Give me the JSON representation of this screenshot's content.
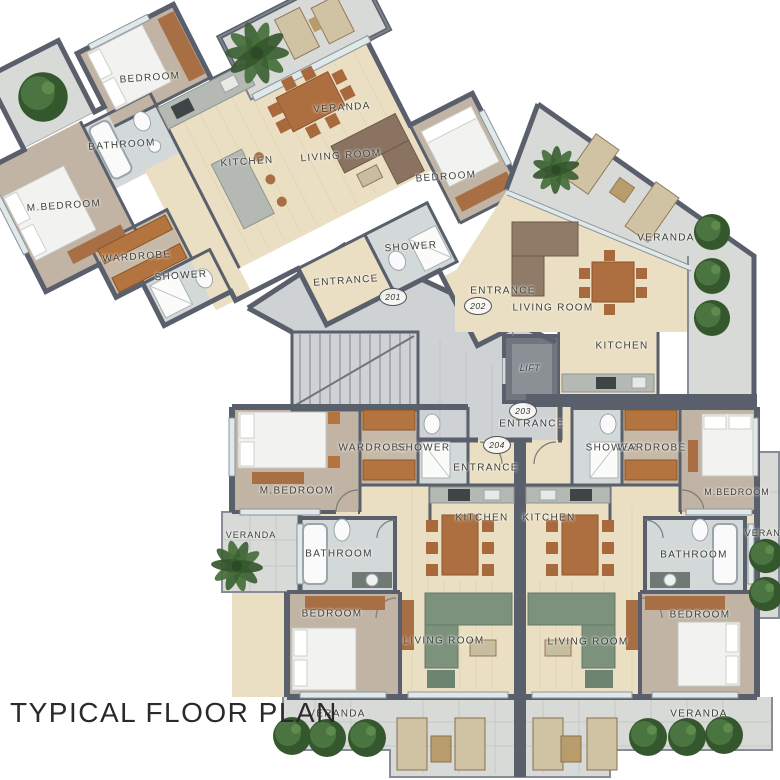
{
  "title": "TYPICAL FLOOR PLAN",
  "core": {
    "lift": "LIFT"
  },
  "units": [
    {
      "number": "201",
      "rooms": {
        "bedroom": "BEDROOM",
        "bathroom": "BATHROOM",
        "master_bedroom": "M.BEDROOM",
        "wardrobe": "WARDROBE",
        "shower": "SHOWER",
        "kitchen": "KITCHEN",
        "living_room": "LIVING ROOM",
        "veranda": "VERANDA",
        "entrance": "ENTRANCE"
      }
    },
    {
      "number": "202",
      "rooms": {
        "bedroom": "BEDROOM",
        "shower": "SHOWER",
        "entrance": "ENTRANCE",
        "living_room": "LIVING ROOM",
        "kitchen": "KITCHEN",
        "veranda": "VERANDA"
      }
    },
    {
      "number": "203",
      "rooms": {
        "entrance": "ENTRANCE",
        "kitchen": "KITCHEN",
        "living_room": "LIVING ROOM",
        "shower": "SHOWER",
        "wardrobe": "WARDROBE",
        "master_bedroom": "M.BEDROOM",
        "bathroom": "BATHROOM",
        "bedroom": "BEDROOM",
        "veranda_side": "VERANDA",
        "veranda_bottom": "VERANDA"
      }
    },
    {
      "number": "204",
      "rooms": {
        "entrance": "ENTRANCE",
        "wardrobe": "WARDROBE",
        "shower": "SHOWER",
        "master_bedroom": "M.BEDROOM",
        "veranda_side": "VERANDA",
        "bathroom": "BATHROOM",
        "kitchen": "KITCHEN",
        "bedroom": "BEDROOM",
        "living_room": "LIVING ROOM",
        "veranda_bottom": "VERANDA"
      }
    }
  ],
  "colors": {
    "wall": "#5a5f6c",
    "wood_light": "#ebdfc3",
    "wood_gray": "#c1b4a4",
    "tile": "#d8dad7",
    "marble": "#d3d8d8",
    "sofa_green": "#7c927c",
    "furniture_brown": "#b0713d",
    "plant_green": "#3c6133",
    "window": "#dfe9ea"
  }
}
